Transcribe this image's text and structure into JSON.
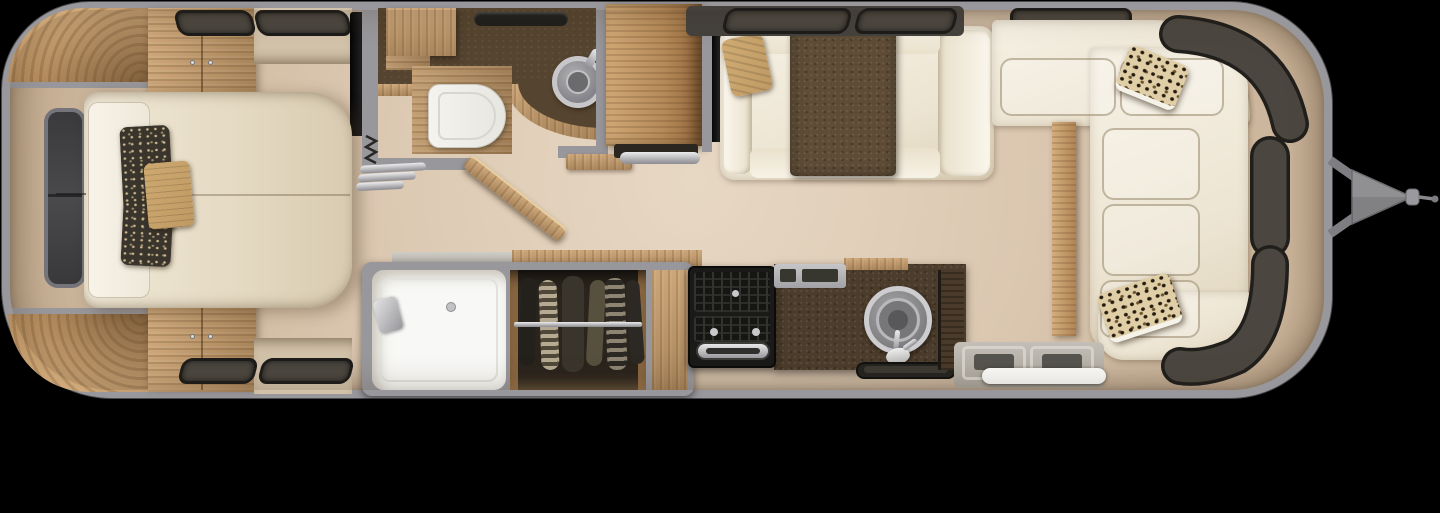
{
  "title": "Travel trailer floor plan - overhead view",
  "colors": {
    "bg": "#000000",
    "shell": "#98979b",
    "floor": "#dbc7b0",
    "floor_light": "#e7d8c4",
    "floor_dark": "#c3ac91",
    "wood": "#cda77a",
    "wood_dark": "#a8845a",
    "wood_deep": "#7a5c38",
    "counter": "#4c3c2b",
    "vanity": "#55442f",
    "cream": "#ede5d3",
    "cream_light": "#f6f1e5",
    "white": "#f8f8f6",
    "window": "#4b4740",
    "window_frame": "#1d1c1a",
    "silver": "#c9c9cb",
    "steel": "#8e8e90",
    "tv": "#141414",
    "charcoal_pillow": "#39342c",
    "tan_pillow": "#bf9963",
    "blanket": "#5e4c36"
  },
  "regions": {
    "bedroom": {
      "label": "Bedroom with bed, wardrobes and corner cabinets"
    },
    "bathroom": {
      "label": "Bathroom with toilet, round sink and vanity"
    },
    "shower": {
      "label": "Shower stall"
    },
    "closet": {
      "label": "Wardrobe closet with hanging clothes"
    },
    "pantry": {
      "label": "Pantry cabinet"
    },
    "dinette": {
      "label": "Dinette sofa with table and TV"
    },
    "kitchen": {
      "label": "Galley kitchen with cooktop and round sink"
    },
    "lounge": {
      "label": "Wraparound lounge with accent pillows"
    },
    "entry": {
      "label": "Entry step"
    },
    "hitch": {
      "label": "A-frame tow hitch"
    }
  },
  "items": {
    "bed": "Bed with pillows",
    "front_window": "Front window",
    "roof_vent": "Roof vent",
    "toilet": "Toilet",
    "bath_sink": "Round lavatory sink",
    "bath_door": "Swinging bath door",
    "accordion_door": "Folding privacy door",
    "closet_rod": "Closet rod",
    "shower_head": "Shower head",
    "stove": "Cooktop and oven",
    "kitchen_sink": "Round galley sink",
    "entry_step": "Entry step with white rim",
    "wrap_windows": "Wraparound tinted windows",
    "tow_hitch": "Tow coupler"
  }
}
